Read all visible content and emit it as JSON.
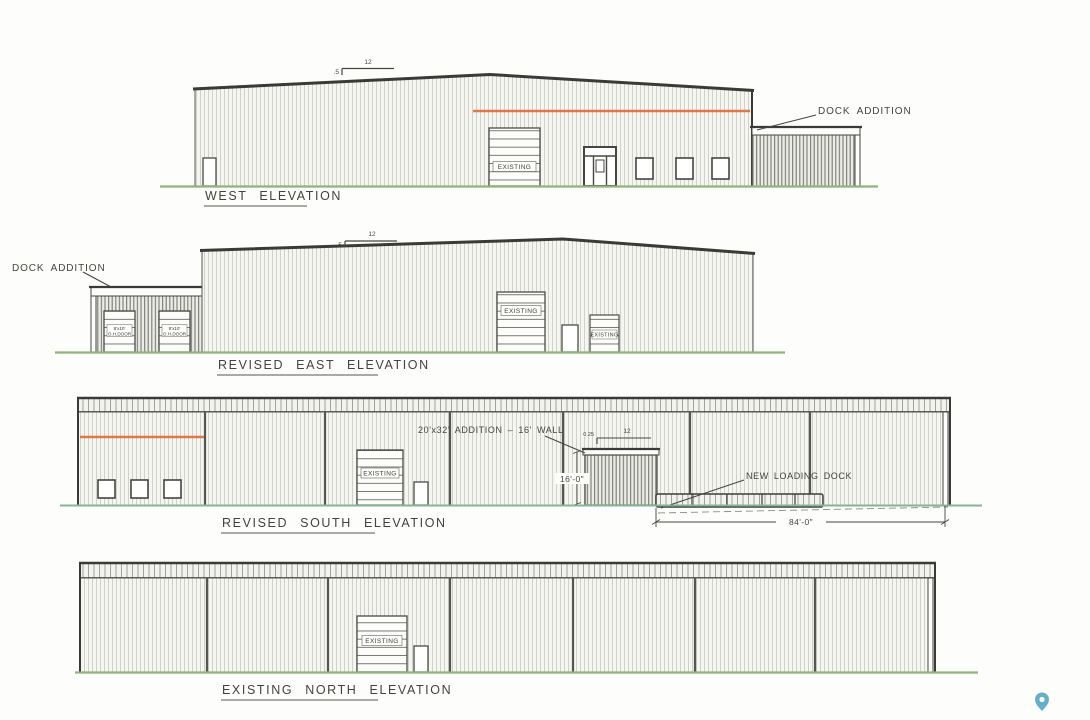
{
  "colors": {
    "ink": "#4b4c46",
    "roof_ink": "#3a3b36",
    "accent_orange": "#e0794a",
    "ground_green": "#8fb478",
    "ground_teal": "#82b597",
    "pin_blue": "#66afcb"
  },
  "west": {
    "title": "WEST ELEVATION",
    "slope": {
      "rise": ".5",
      "run": "12"
    },
    "dock_addition_label": "DOCK ADDITION",
    "overhead_door_label": "EXISTING"
  },
  "east": {
    "title": "REVISED EAST ELEVATION",
    "dock_addition_label": "DOCK ADDITION",
    "slope": {
      "rise": ".5",
      "run": "12"
    },
    "dock_doors": {
      "size": "8'x10'",
      "type": "O.H.DOOR"
    },
    "large_door_label": "EXISTING",
    "small_door_label": "EXISTING"
  },
  "south": {
    "title": "REVISED SOUTH ELEVATION",
    "addition_note": "20'x32' ADDITION – 16' WALL",
    "addition_wall_height": "16'-0\"",
    "slope": {
      "rise": "0.25",
      "run": "12"
    },
    "loading_dock_label": "NEW LOADING DOCK",
    "overall_dim": "84'-0\"",
    "overhead_door_label": "EXISTING"
  },
  "north": {
    "title": "EXISTING NORTH ELEVATION",
    "overhead_door_label": "EXISTING"
  }
}
